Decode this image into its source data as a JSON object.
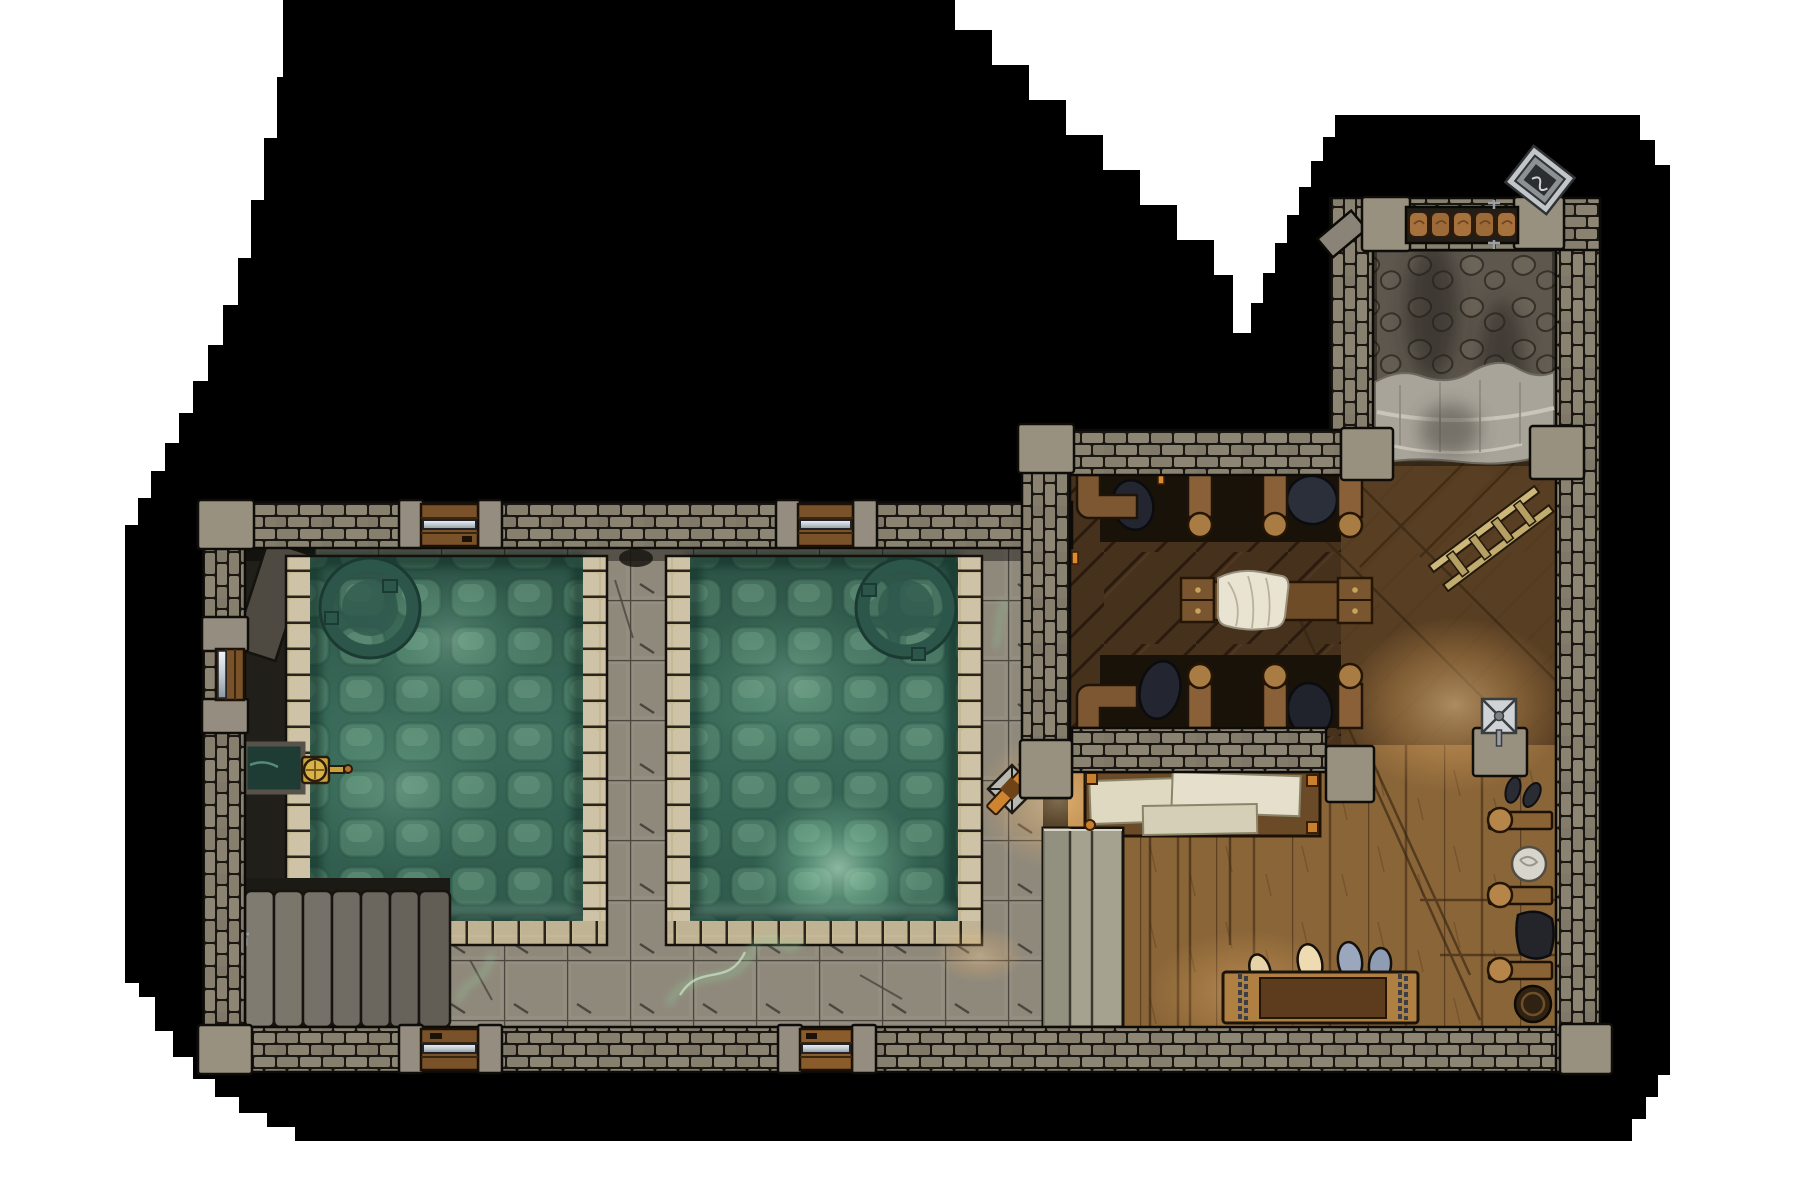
{
  "meta": {
    "type": "battle-map",
    "setting": "bathhouse-interior",
    "view": "top-down",
    "canvas": {
      "width": 1800,
      "height": 1200
    },
    "background": "#ffffff",
    "void": "#000000"
  },
  "rooms": [
    {
      "id": "bath-hall",
      "label": "bath hall with two sunken green pools",
      "x": 200,
      "y": 502,
      "w": 872,
      "h": 570
    },
    {
      "id": "changing-room",
      "label": "wooden changing room with stalls and benches",
      "x": 1020,
      "y": 425,
      "w": 580,
      "h": 647
    },
    {
      "id": "tower-alcove",
      "label": "stone alcove with hanging curtain",
      "x": 1330,
      "y": 198,
      "w": 270,
      "h": 275
    }
  ],
  "features": [
    {
      "name": "pool-west",
      "label": "sunken pool with cobbled bottom",
      "x": 286,
      "y": 548,
      "w": 324,
      "h": 397
    },
    {
      "name": "pool-east",
      "label": "sunken pool with cobbled bottom and glow",
      "x": 666,
      "y": 548,
      "w": 316,
      "h": 397
    },
    {
      "name": "drain-ring-west",
      "cx": 370,
      "cy": 608,
      "r": 43
    },
    {
      "name": "drain-ring-east",
      "cx": 906,
      "cy": 608,
      "r": 43
    },
    {
      "name": "water-valve",
      "label": "bronze valve and inflow channel",
      "x": 245,
      "y": 742,
      "w": 100,
      "h": 50
    },
    {
      "name": "stairs",
      "label": "wide stone steps",
      "x": 245,
      "y": 891,
      "w": 205,
      "h": 136
    },
    {
      "name": "rolled-mats-rack",
      "x": 211,
      "y": 922,
      "w": 32,
      "h": 106
    },
    {
      "name": "door-north-west",
      "x": 421,
      "y": 504,
      "w": 57,
      "h": 42
    },
    {
      "name": "door-north-east",
      "x": 798,
      "y": 504,
      "w": 55,
      "h": 42
    },
    {
      "name": "door-south-west",
      "x": 421,
      "y": 1029,
      "w": 57,
      "h": 41
    },
    {
      "name": "door-south-east",
      "x": 800,
      "y": 1029,
      "w": 52,
      "h": 41
    },
    {
      "name": "door-west",
      "x": 216,
      "y": 649,
      "w": 28,
      "h": 51
    },
    {
      "name": "changing-stalls",
      "label": "two rows of cubicles with hanging clothes",
      "x": 1072,
      "y": 475,
      "w": 290,
      "h": 253
    },
    {
      "name": "massage-table",
      "label": "table with drawers and white towel",
      "x": 1181,
      "y": 573,
      "w": 191,
      "h": 55
    },
    {
      "name": "towel-table",
      "label": "low table stacked with folded towels",
      "x": 1085,
      "y": 772,
      "w": 235,
      "h": 64
    },
    {
      "name": "privacy-screen",
      "x": 1043,
      "y": 828,
      "w": 80,
      "h": 199
    },
    {
      "name": "drying-rack",
      "label": "x-frame rack with orange cloth",
      "x": 988,
      "y": 763,
      "w": 50,
      "h": 52
    },
    {
      "name": "wall-sconce",
      "label": "metal sconce on stone stub, warm light",
      "x": 1473,
      "y": 698,
      "w": 54,
      "h": 78
    },
    {
      "name": "coat-hooks",
      "label": "three peg rails on east wall",
      "x": 1487,
      "y": 812,
      "w": 65,
      "h": 176
    },
    {
      "name": "jar",
      "cx": 1529,
      "cy": 864,
      "r": 17
    },
    {
      "name": "hanging-clothes-east",
      "x": 1514,
      "y": 912,
      "w": 40,
      "h": 48
    },
    {
      "name": "barrel",
      "cx": 1533,
      "cy": 1004,
      "r": 18
    },
    {
      "name": "shoe-bench",
      "label": "bench with chains and four slippers",
      "x": 1223,
      "y": 948,
      "w": 195,
      "h": 75
    },
    {
      "name": "ladder",
      "label": "leaning ladder",
      "x1": 1429,
      "y1": 578,
      "x2": 1551,
      "y2": 487
    },
    {
      "name": "curtain",
      "label": "gray drape across alcove opening",
      "x": 1375,
      "y": 372,
      "w": 179,
      "h": 80
    },
    {
      "name": "basket-shelf",
      "label": "five woven baskets on wall shelf",
      "x": 1406,
      "y": 207,
      "w": 112,
      "h": 36
    },
    {
      "name": "framed-sign",
      "label": "tilted metal-framed sign outside wall",
      "x": 1515,
      "y": 157,
      "w": 52,
      "h": 46
    },
    {
      "name": "green-wisps",
      "label": "green vapor on floor",
      "spots": [
        [
          700,
          975
        ],
        [
          470,
          975
        ],
        [
          1000,
          620
        ]
      ]
    }
  ],
  "colors": {
    "background": "#ffffff",
    "void": "#000000",
    "wall_brick": "#87806f",
    "wall_block": "#98917f",
    "stone_floor": "#8f897b",
    "stone_dark": "#22201a",
    "pool_rim": "#c6b894",
    "pool_water": "#356353",
    "pool_cobble": "#5f927a",
    "drain_ring": "#2c564a",
    "pool_glow": "#b9ecca",
    "stair_slab": "#7b766c",
    "wood_dark": "#46311c",
    "wood_mid": "#5a4023",
    "wood_light": "#8a6538",
    "beam_wood": "#7d5731",
    "knob_wood": "#a97c43",
    "towel": "#e6dfcb",
    "curtain": "#a8a49a",
    "screen_wood": "#a5a390",
    "metal": "#cfd3d6",
    "chain": "#3c3f45",
    "bench_wood": "#b07f42",
    "bench_panel": "#5c3c1d",
    "slipper_cream": "#e8d3a8",
    "slipper_blue": "#9aa7bd",
    "clothes_dark": "#232630",
    "basket": "#a5713c",
    "orange_wood": "#cf842f",
    "valve_brass": "#c9a23c",
    "glow_warm": "#f0b569",
    "wisp_green": "#8fca9b",
    "channel_water": "#1e3b34"
  }
}
